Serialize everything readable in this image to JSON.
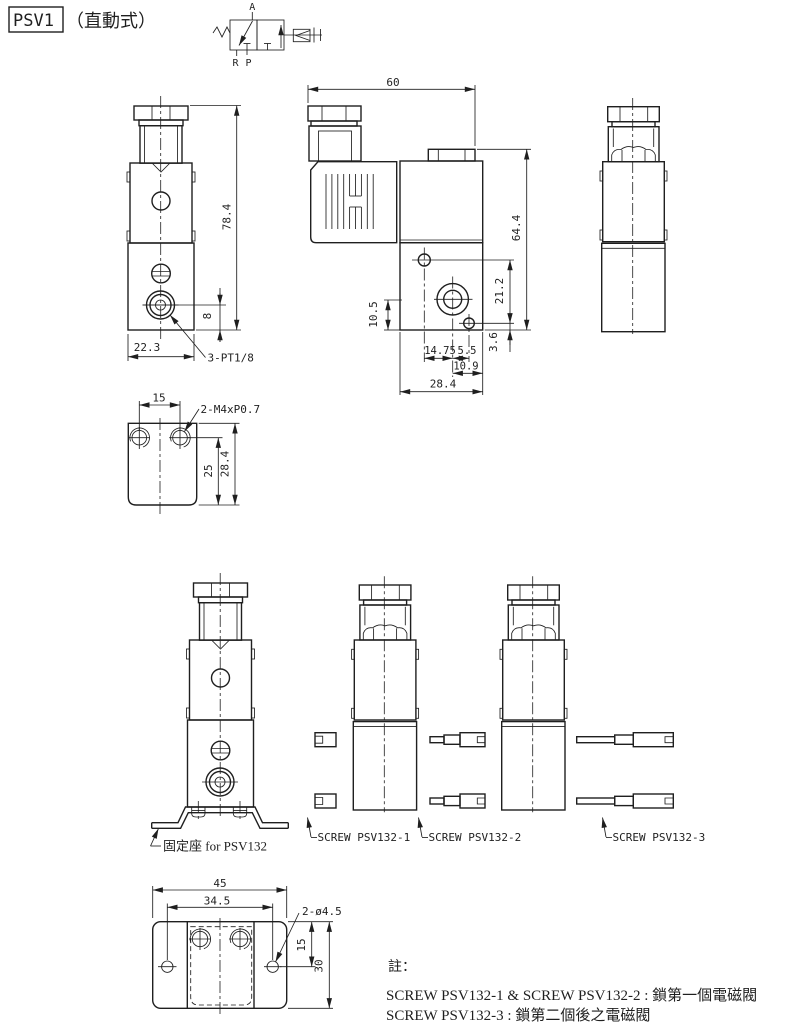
{
  "colors": {
    "line": "#1f1f1f",
    "background": "#ffffff"
  },
  "title": {
    "model": "PSV1",
    "type_label": "（直動式）"
  },
  "valve_symbol": {
    "port_a": "A",
    "port_r": "R",
    "port_p": "P"
  },
  "front_view": {
    "dim_height": "78.4",
    "dim_port_to_bottom": "8",
    "dim_width": "22.3",
    "port_thread_label": "3-PT1/8"
  },
  "side_view": {
    "dim_width": "60",
    "dim_height": "64.4",
    "dim_hole_to_hole_v": "21.2",
    "dim_port_to_bottom": "10.5",
    "dim_hole_to_port_h": "14.75",
    "dim_port_to_hole_h": "5.5",
    "dim_hole_to_bottom": "3.6",
    "dim_port_to_edge": "10.9",
    "dim_body_width": "28.4"
  },
  "bracket_side_view": {
    "dim_hole_spacing": "15",
    "thread_label": "2-M4xP0.7",
    "dim_hole_to_bottom": "25",
    "dim_height": "28.4"
  },
  "assembly_view": {
    "bracket_label": "固定座 for PSV132",
    "screw_label_1": "SCREW PSV132-1",
    "screw_label_2": "SCREW PSV132-2",
    "screw_label_3": "SCREW PSV132-3"
  },
  "bracket_top_view": {
    "dim_width": "45",
    "dim_hole_spacing": "34.5",
    "hole_label": "2-ø4.5",
    "dim_hole_offset": "15",
    "dim_depth": "30"
  },
  "notes": {
    "heading": "註：",
    "line1": "SCREW PSV132-1 & SCREW PSV132-2 : 鎖第一個電磁閥",
    "line2": "SCREW PSV132-3 : 鎖第二個後之電磁閥"
  }
}
